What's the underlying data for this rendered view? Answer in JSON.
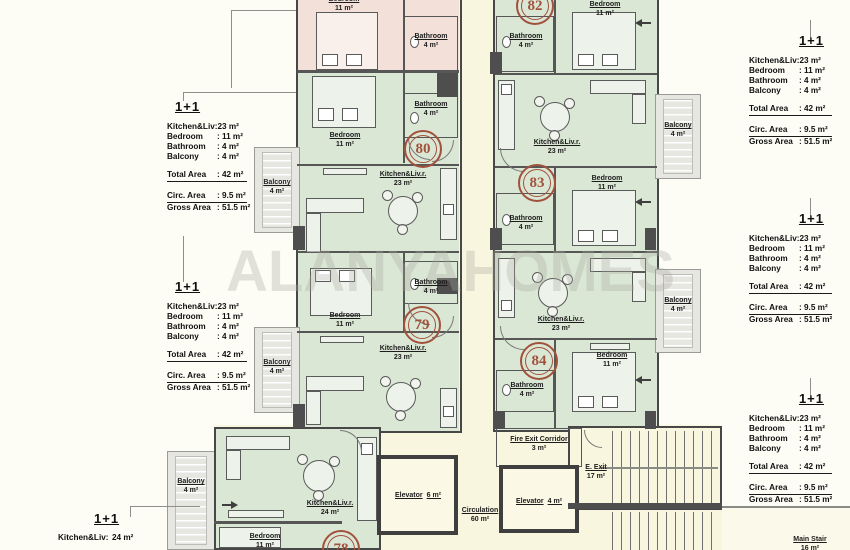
{
  "watermark": "ALANYAHOMES",
  "palette": {
    "unit_green": "#dbe7d5",
    "unit_pink": "#f3e1d9",
    "corridor_cream": "#f9f6df",
    "balcony_gray": "#e7e7e2",
    "wall_dark": "#4e4e4e",
    "accent_red": "#a0523c"
  },
  "spec_standard": {
    "title": "1+1",
    "rows": [
      {
        "label": "Kitchen&Liv:",
        "value": "23 m²"
      },
      {
        "label": "Bedroom",
        "value": ": 11 m²"
      },
      {
        "label": "Bathroom",
        "value": ": 4 m²"
      },
      {
        "label": "Balcony",
        "value": ": 4 m²"
      }
    ],
    "total": {
      "label": "Total Area",
      "value": ": 42 m²"
    },
    "circ": {
      "label": "Circ. Area",
      "value": ": 9.5 m²"
    },
    "gross": {
      "label": "Gross Area",
      "value": ": 51.5 m²"
    }
  },
  "spec_partial": {
    "title": "1+1",
    "row": {
      "label": "Kitchen&Liv:",
      "value": "24 m²"
    }
  },
  "circles": {
    "u78": "78",
    "u79": "79",
    "u80": "80",
    "u82": "82",
    "u83": "83",
    "u84": "84"
  },
  "rooms": {
    "bedroom_top": {
      "name": "Bedroom",
      "area": "11 m²"
    },
    "bathroom_top": {
      "name": "Bathroom",
      "area": "4 m²"
    },
    "bedroom_80": {
      "name": "Bedroom",
      "area": "11 m²"
    },
    "bathroom_80": {
      "name": "Bathroom",
      "area": "4 m²"
    },
    "kitchen_80": {
      "name": "Kitchen&Liv.r.",
      "area": "23 m²"
    },
    "bedroom_79": {
      "name": "Bedroom",
      "area": "11 m²"
    },
    "bathroom_79": {
      "name": "Bathroom",
      "area": "4 m²"
    },
    "kitchen_79": {
      "name": "Kitchen&Liv.r.",
      "area": "23 m²"
    },
    "bedroom_82": {
      "name": "Bedroom",
      "area": "11 m²"
    },
    "bathroom_82": {
      "name": "Bathroom",
      "area": "4 m²"
    },
    "kitchen_82": {
      "name": "Kitchen&Liv.r.",
      "area": "23 m²"
    },
    "bedroom_83": {
      "name": "Bedroom",
      "area": "11 m²"
    },
    "bathroom_83": {
      "name": "Bathroom",
      "area": "4 m²"
    },
    "kitchen_83": {
      "name": "Kitchen&Liv.r.",
      "area": "23 m²"
    },
    "bedroom_84": {
      "name": "Bedroom",
      "area": "11 m²"
    },
    "bathroom_84": {
      "name": "Bathroom",
      "area": "4 m²"
    },
    "kitchen_78": {
      "name": "Kitchen&Liv.r.",
      "area": "24 m²"
    },
    "bedroom_78": {
      "name": "Bedroom",
      "area": "11 m²"
    },
    "balcony_78": {
      "name": "Balcony",
      "area": "4 m²"
    },
    "balcony_left_1": {
      "name": "Balcony",
      "area": "4 m²"
    },
    "balcony_left_2": {
      "name": "Balcony",
      "area": "4 m²"
    },
    "balcony_right_1": {
      "name": "Balcony",
      "area": "4 m²"
    },
    "balcony_right_2": {
      "name": "Balcony",
      "area": "4 m²"
    },
    "fire_exit": {
      "name": "Fire Exit Corridor",
      "area": "3 m²"
    },
    "elevator_6": {
      "name": "Elevator",
      "area": "6 m²"
    },
    "elevator_4": {
      "name": "Elevator",
      "area": "4 m²"
    },
    "circulation": {
      "name": "Circulation",
      "area": "60 m²"
    },
    "e_exit": {
      "name": "E. Exit",
      "area": "17 m²"
    },
    "main_stair": {
      "name": "Main Stair",
      "area": "16 m²"
    }
  }
}
